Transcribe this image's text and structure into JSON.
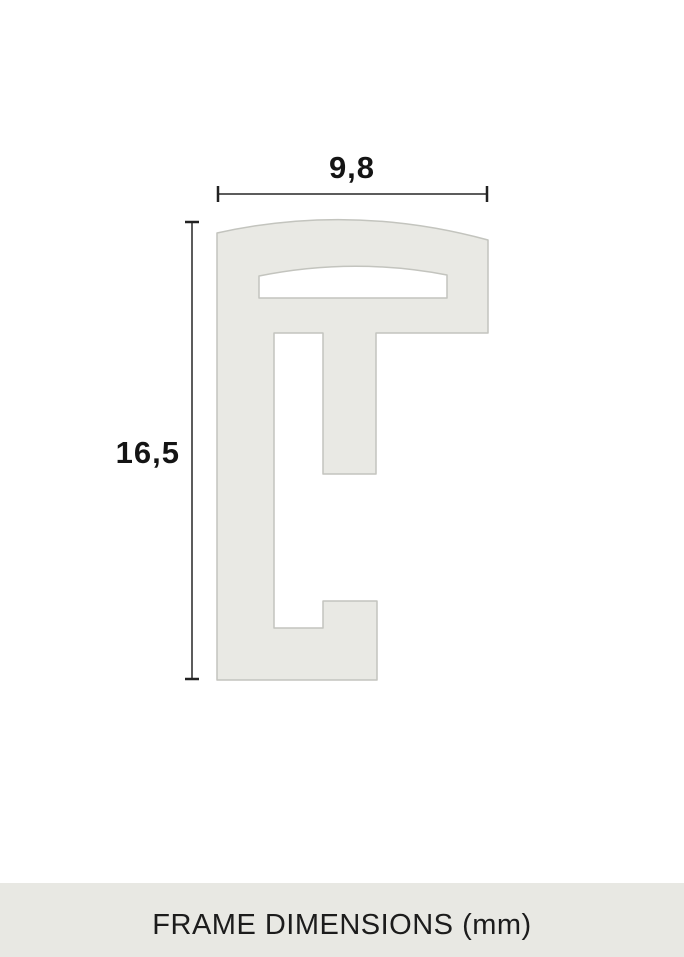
{
  "diagram": {
    "width_dimension": {
      "label": "9,8"
    },
    "height_dimension": {
      "label": "16,5"
    },
    "caption": "FRAME DIMENSIONS (mm)",
    "colors": {
      "background": "#ffffff",
      "profile_fill": "#e9e9e4",
      "profile_stroke": "#c3c4be",
      "dim_line": "#5c5c5c",
      "dim_tick": "#222222",
      "label_text": "#141414",
      "band_bg": "#e8e8e3",
      "caption_text": "#1c1c1c"
    }
  }
}
